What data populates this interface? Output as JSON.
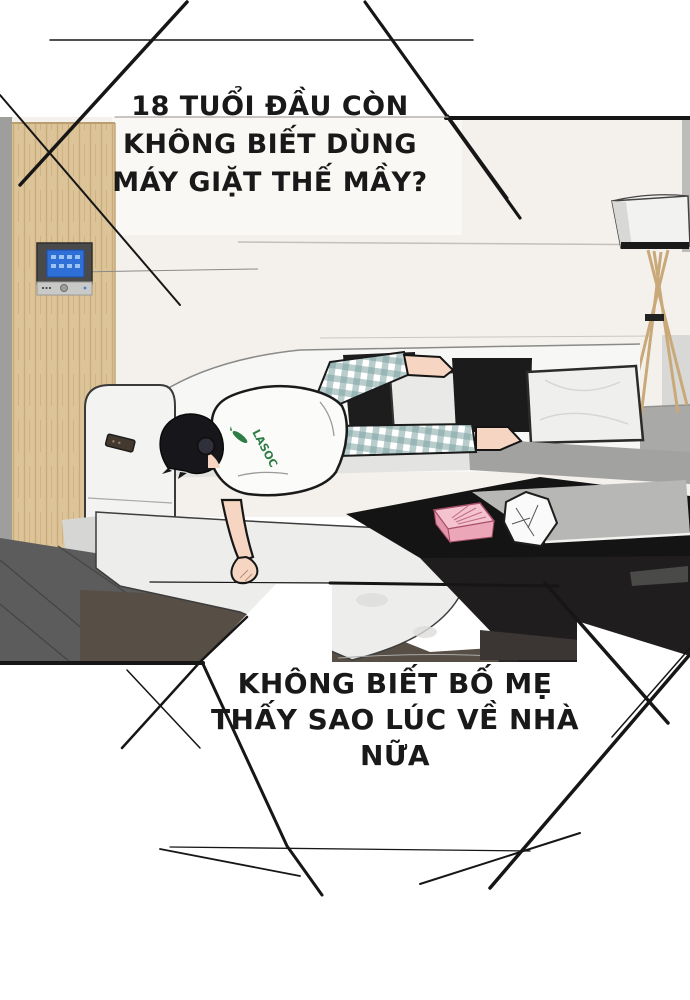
{
  "bubbles": {
    "top": {
      "lines": [
        "18 TUỔI ĐẦU CÒN",
        "KHÔNG BIẾT DÙNG",
        "MÁY GIẶT THẾ MẦY?"
      ]
    },
    "bottom": {
      "lines": [
        "KHÔNG BIẾT BỐ MẸ",
        "THẤY SAO LÚC VỀ NHÀ",
        "NỮA"
      ]
    }
  },
  "scene": {
    "shirt_logo_text": "LASOC",
    "colors": {
      "ink": "#161616",
      "wall_cream": "#f4f1ec",
      "wood_wall": "#dcc398",
      "panel_screen_blue": "#2f6fd8",
      "tissue_box_pink": "#f5c3cf",
      "plaid_teal": "#7fa3a3",
      "logo_green": "#2e7d46",
      "rug_brown": "#574e46",
      "floor_gray": "#5c5c5c",
      "lamp_wood": "#c9a97a"
    }
  }
}
